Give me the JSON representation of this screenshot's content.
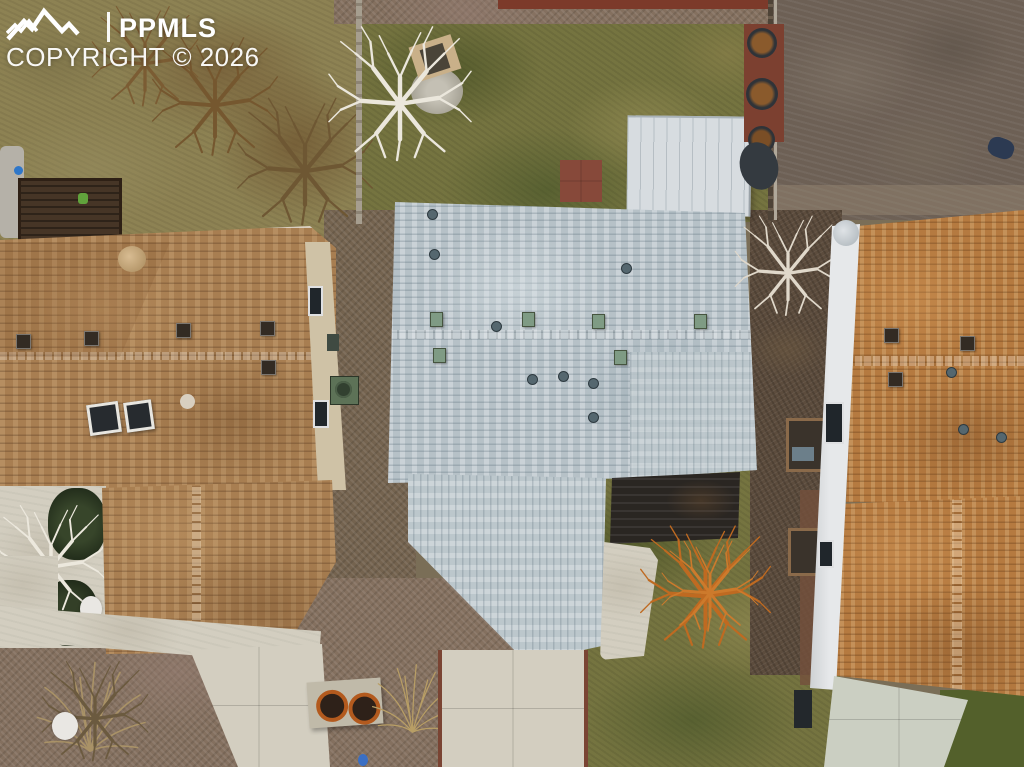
{
  "watermark": {
    "brand": "PPMLS",
    "copyright": "COPYRIGHT © 2026",
    "text_color": "#ffffff",
    "logo": "mountain-range-icon"
  },
  "scene": {
    "type": "aerial-drone-photo",
    "setting": "overhead view of three suburban houses with yards, shed and driveways",
    "houses": [
      {
        "id": "left-house",
        "roof_color": "#a87e51"
      },
      {
        "id": "center-house",
        "roof_color": "#b6c1c7"
      },
      {
        "id": "right-house",
        "roof_color": "#b57a40"
      }
    ],
    "ground_colors": {
      "lawn": "#757440",
      "dirt": "#6d6055",
      "gravel": "#74634f",
      "dry_grass": "#8d8253",
      "concrete": "#d3cec0",
      "shed_roof": "#d7dce0"
    }
  }
}
